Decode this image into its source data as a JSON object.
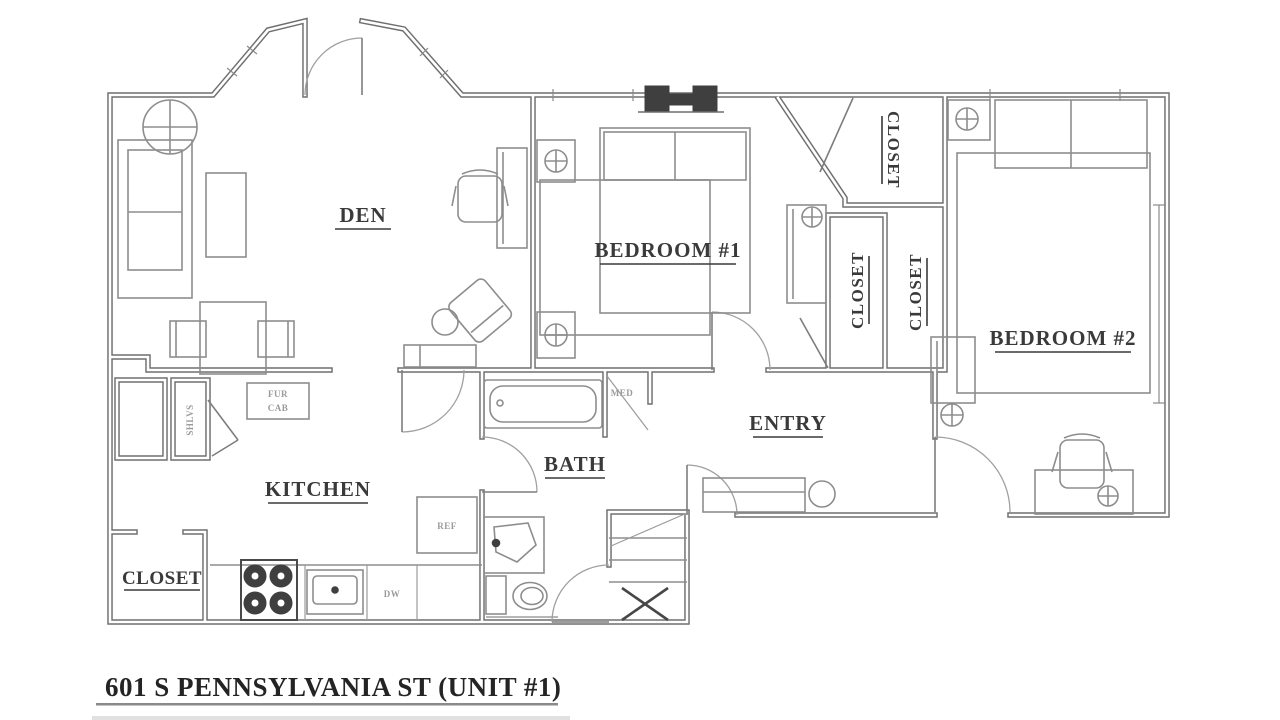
{
  "title": {
    "text": "601 S PENNSYLVANIA ST (UNIT #1)"
  },
  "rooms": {
    "den": "DEN",
    "bedroom1": "BEDROOM #1",
    "bedroom2": "BEDROOM #2",
    "entry": "ENTRY",
    "kitchen": "KITCHEN",
    "bath": "BATH",
    "closet_bedroom1": "CLOSET",
    "closet_hall_left": "CLOSET",
    "closet_hall_right": "CLOSET",
    "closet_kitchen": "CLOSET"
  },
  "fixtures": {
    "furnace_cabinet_line1": "FUR",
    "furnace_cabinet_line2": "CAB",
    "shelves": "SHLVS",
    "refrigerator": "REF",
    "dishwasher": "DW",
    "medicine_cabinet": "MED"
  },
  "colors": {
    "wall_line": "#6f6f6f",
    "furniture_line": "#8d8d8d",
    "label_text": "#3a3a3a",
    "small_label_text": "#9a9a9a",
    "dark_fixture": "#3f3f3f",
    "background": "#ffffff"
  }
}
